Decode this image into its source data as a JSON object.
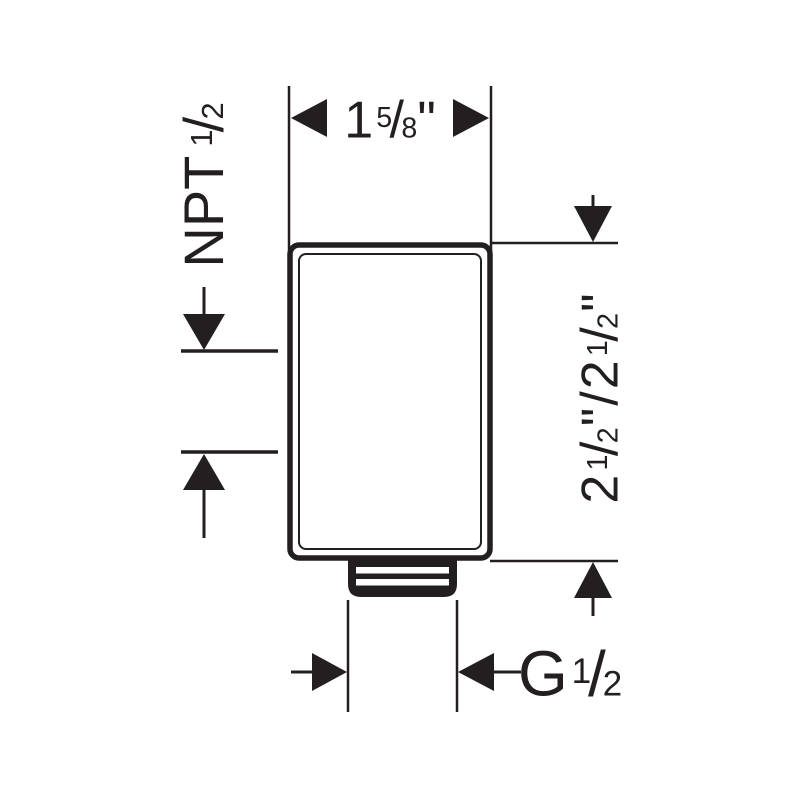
{
  "drawing": {
    "kind": "technical-dimension-drawing",
    "line_color": "#231f20",
    "background_color": "#ffffff"
  },
  "dims": {
    "top": {
      "whole": "1",
      "num": "5",
      "slash": "/",
      "den": "8",
      "unit": "\""
    },
    "left": {
      "label": "NPT",
      "num": "1",
      "slash": "/",
      "den": "2"
    },
    "right": {
      "first": {
        "whole": "2",
        "num": "1",
        "slash": "/",
        "den": "2",
        "unit": "\""
      },
      "separator": "/",
      "second": {
        "whole": "2",
        "num": "1",
        "slash": "/",
        "den": "2",
        "unit": "\""
      }
    },
    "bottom": {
      "label": "G",
      "num": "1",
      "slash": "/",
      "den": "2"
    }
  }
}
